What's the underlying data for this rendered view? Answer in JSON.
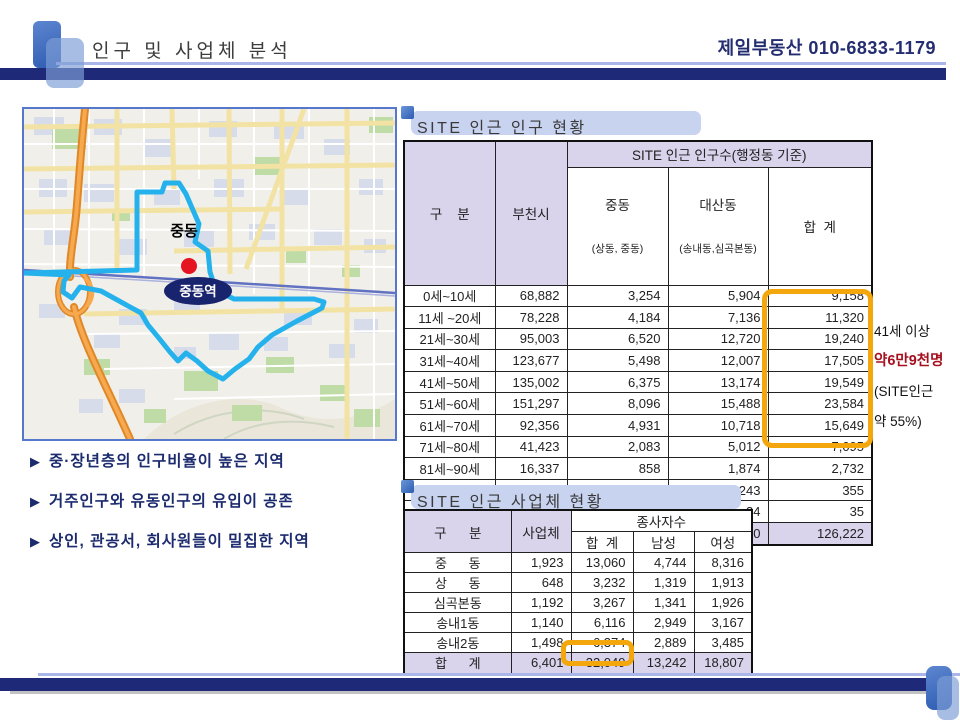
{
  "header": {
    "title": "인구 및 사업체 분석",
    "contact": "제일부동산 010-6833-1179"
  },
  "map": {
    "area_label": "중동",
    "station_label": "중동역"
  },
  "bullets": {
    "marker": "▶",
    "items": [
      "중·장년층의 인구비율이 높은 지역",
      "거주인구와 유동인구의 유입이 공존",
      "상인, 관공서, 회사원들이 밀집한 지역"
    ]
  },
  "population_table": {
    "title": "SITE 인근 인구 현황",
    "col_group": "구    분",
    "col_bucheon": "부천시",
    "col_span_header": "SITE 인근 인구수(행정동 기준)",
    "col_jungdong": "중동",
    "col_jungdong_sub": "(상동, 중동)",
    "col_daesan": "대산동",
    "col_daesan_sub": "(송내동,심곡본동)",
    "col_total": "합  계",
    "rows": [
      [
        "0세~10세",
        "68,882",
        "3,254",
        "5,904",
        "9,158"
      ],
      [
        "11세 ~20세",
        "78,228",
        "4,184",
        "7,136",
        "11,320"
      ],
      [
        "21세~30세",
        "95,003",
        "6,520",
        "12,720",
        "19,240"
      ],
      [
        "31세~40세",
        "123,677",
        "5,498",
        "12,007",
        "17,505"
      ],
      [
        "41세~50세",
        "135,002",
        "6,375",
        "13,174",
        "19,549"
      ],
      [
        "51세~60세",
        "151,297",
        "8,096",
        "15,488",
        "23,584"
      ],
      [
        "61세~70세",
        "92,356",
        "4,931",
        "10,718",
        "15,649"
      ],
      [
        "71세~80세",
        "41,423",
        "2,083",
        "5,012",
        "7,095"
      ],
      [
        "81세~90세",
        "16,337",
        "858",
        "1,874",
        "2,732"
      ],
      [
        "91세~100세",
        "2,135",
        "112",
        "243",
        "355"
      ],
      [
        "100세 이상",
        "189",
        "11",
        "24",
        "35"
      ]
    ],
    "totals": [
      [
        "합    계",
        "804,529",
        "41,922",
        "84,300",
        "126,222"
      ]
    ]
  },
  "annotation": {
    "line1": "41세 이상",
    "line2": "약6만9천명",
    "line3": "(SITE인근",
    "line4": "약 55%)"
  },
  "business_table": {
    "title": "SITE 인근 사업체 현황",
    "col_group": "구      분",
    "col_business": "사업체",
    "col_span_header": "종사자수",
    "col_total": "합  계",
    "col_male": "남성",
    "col_female": "여성",
    "rows": [
      [
        "중      동",
        "1,923",
        "13,060",
        "4,744",
        "8,316"
      ],
      [
        "상      동",
        "648",
        "3,232",
        "1,319",
        "1,913"
      ],
      [
        "심곡본동",
        "1,192",
        "3,267",
        "1,341",
        "1,926"
      ],
      [
        "송내1동",
        "1,140",
        "6,116",
        "2,949",
        "3,167"
      ],
      [
        "송내2동",
        "1,498",
        "6,374",
        "2,889",
        "3,485"
      ]
    ],
    "totals": [
      [
        "합      계",
        "6,401",
        "32,049",
        "13,242",
        "18,807"
      ]
    ]
  },
  "colors": {
    "navy_bar": "#1e2a78",
    "light_blue_line": "#aab6e8",
    "table_header_lavender": "#d9d3ec",
    "title_banner_blue": "#c8d3f0",
    "highlight_orange": "#f3a70c",
    "annotation_red": "#a6101e",
    "site_boundary_cyan": "#25b2ec",
    "station_badge_navy": "#19246e",
    "marker_red": "#e51420"
  }
}
